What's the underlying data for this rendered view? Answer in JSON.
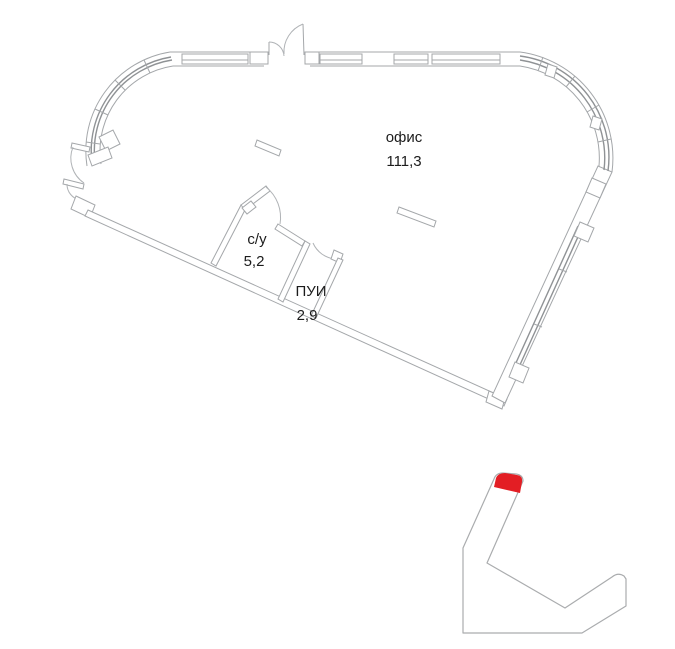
{
  "plan": {
    "title": "floor plan",
    "rooms": [
      {
        "name": "офис",
        "area": "111,3"
      },
      {
        "name": "с/у",
        "area": "5,2"
      },
      {
        "name": "ПУИ",
        "area": "2,9"
      }
    ]
  },
  "minimap": {
    "highlight_color": "#e31e24",
    "outline_color": "#aaacae"
  },
  "colors": {
    "wall_line": "#a4a7aa",
    "glass_line": "#8f9295",
    "text": "#1c1c1c",
    "background": "#ffffff"
  }
}
